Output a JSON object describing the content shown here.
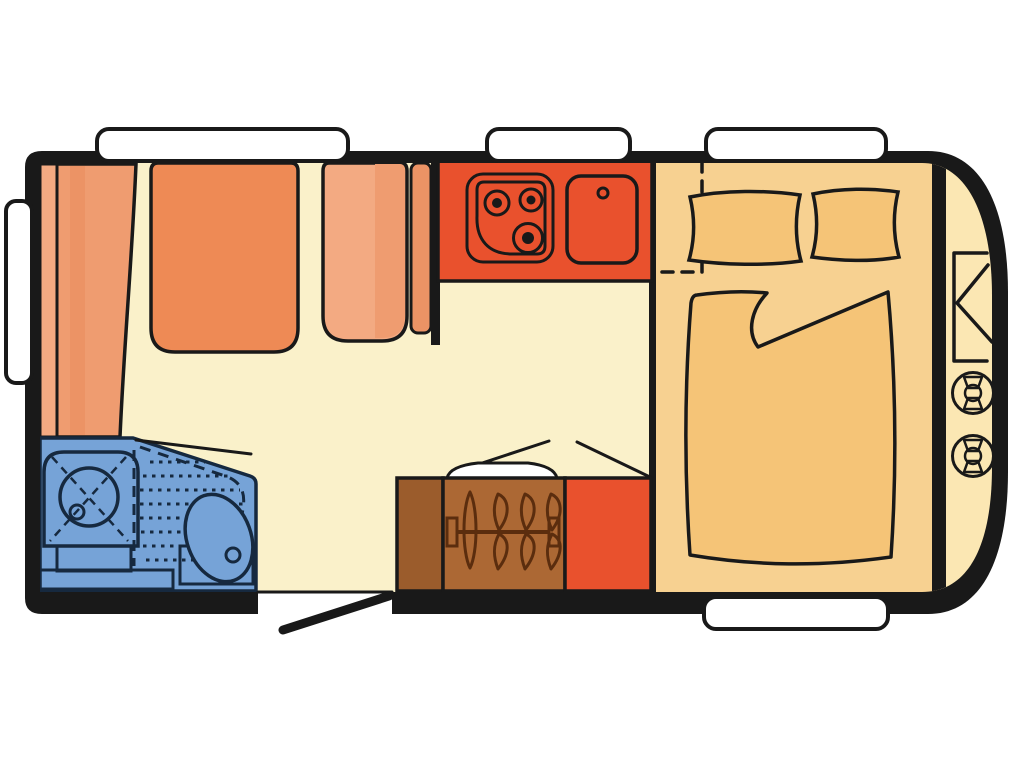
{
  "title": "Caravan floor plan",
  "diagram": {
    "type": "caravan-floor-plan",
    "view": "top-down",
    "text_labels": [],
    "window_count": 5
  },
  "colors": {
    "page": "#ffffff",
    "wall": "#191919",
    "outline": "#191919",
    "floor_living": "#faf1ca",
    "floor_bedroom": "#f7d191",
    "floor_front_locker": "#fbe7b3",
    "window_white": "#ffffff",
    "seat_orange": "#ee8a55",
    "seat_salmon_light": "#f3aa82",
    "seat_salmon": "#ef9c70",
    "seat_salmon_shade": "#ec9365",
    "kitchen_red": "#e9512d",
    "fridge_red": "#e9512d",
    "wardrobe_brown": "#ac6834",
    "wardrobe_brown_dark": "#9b5c2c",
    "wardrobe_wood_line": "#5b2d0e",
    "bathroom_blue": "#76a3d7",
    "bathroom_line": "#16293f",
    "bed_fabric": "#f5c477",
    "shelf_white": "#ffffff"
  },
  "elements": [
    {
      "id": "lounge",
      "icon": "l-shaped-seating"
    },
    {
      "id": "kitchen",
      "icon": "three-burner-hob-and-sink"
    },
    {
      "id": "bathroom",
      "icon": "shower-and-toilet"
    },
    {
      "id": "wardrobe",
      "icon": "clothes-rail-with-hangers"
    },
    {
      "id": "fridge",
      "icon": "fridge-cabinet"
    },
    {
      "id": "bedroom",
      "icon": "double-bed-with-pillows"
    },
    {
      "id": "front_locker",
      "icon": "two-gas-bottles"
    },
    {
      "id": "entrance",
      "icon": "open-door-swing"
    }
  ]
}
